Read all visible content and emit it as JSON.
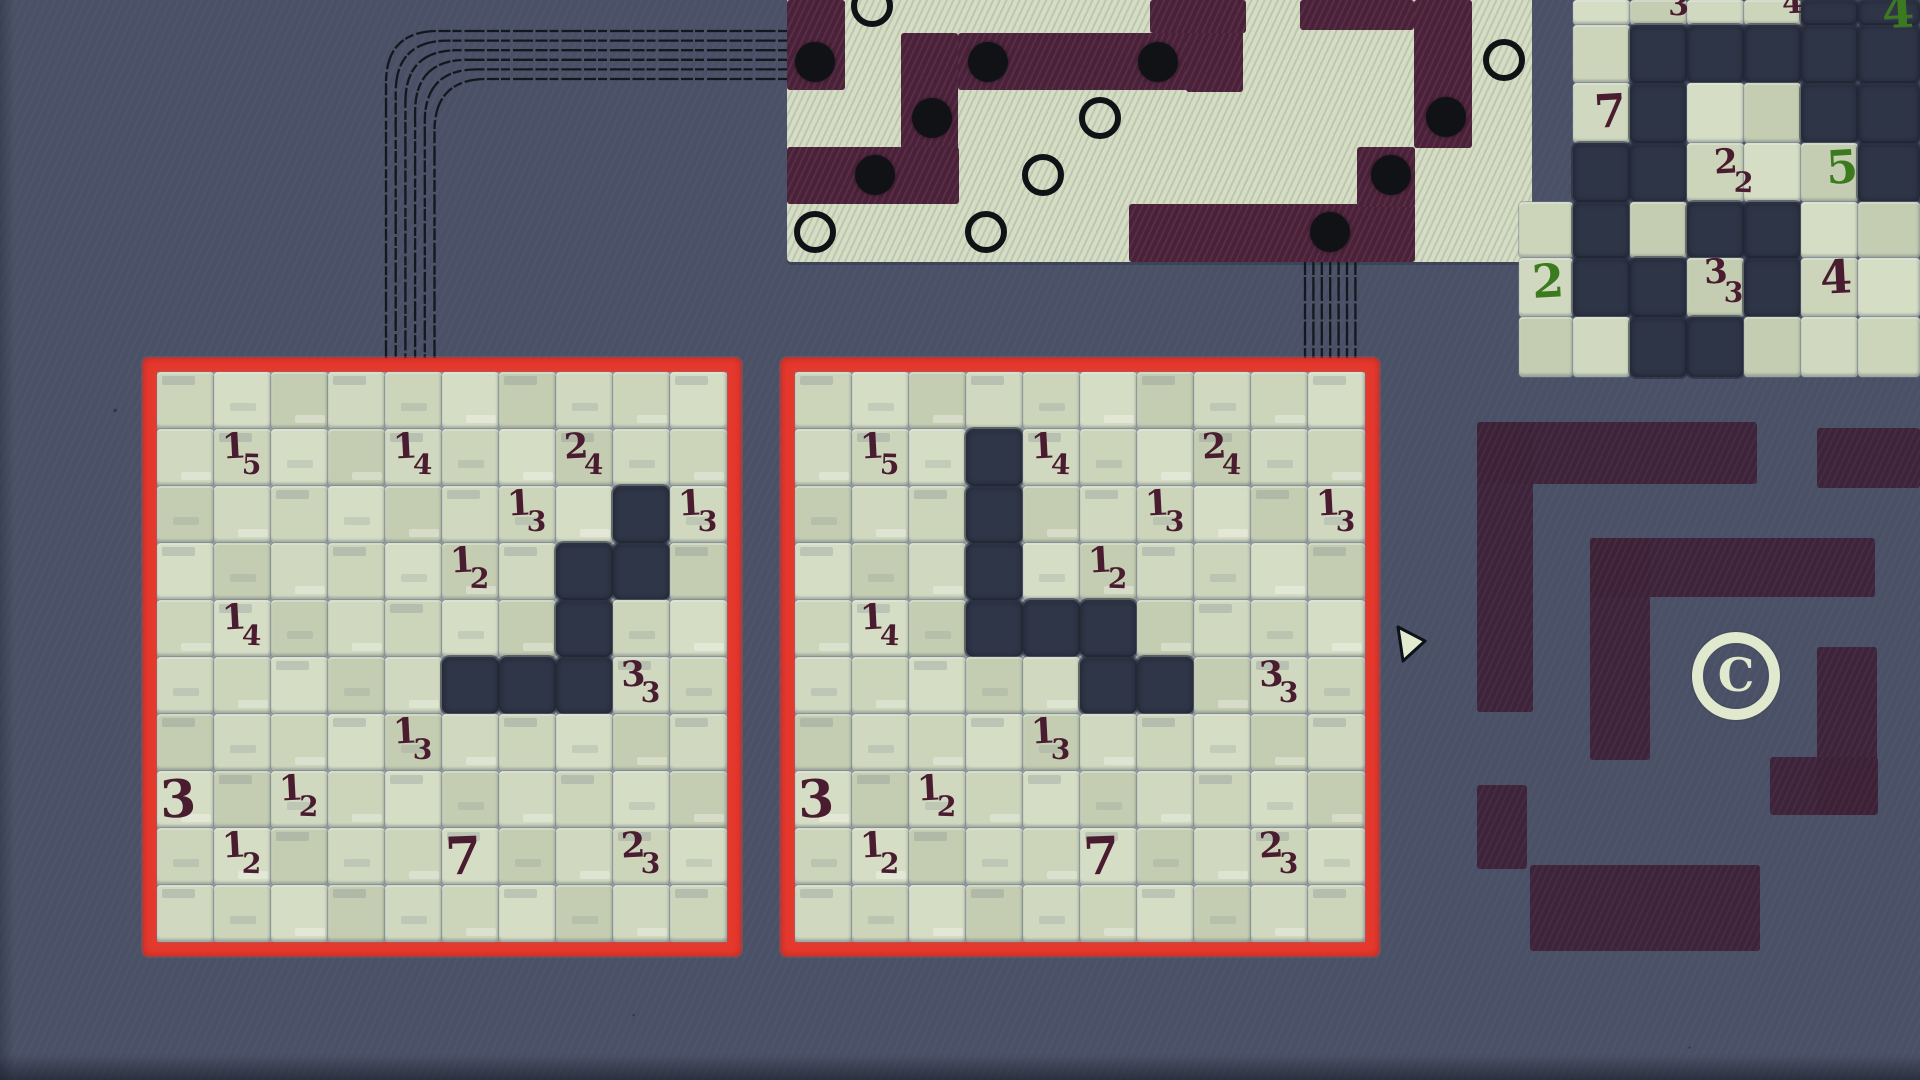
{
  "palette": {
    "background": "#4a5166",
    "frame_red": "#e6392e",
    "cell_dark": "#2f3648",
    "cell_cream_shades": [
      "#ccd4ba",
      "#d6ddc5",
      "#c4cdb1",
      "#d0d8bf"
    ],
    "clue_maroon": "#4a1c30",
    "clue_green": "#3c7a1f",
    "fabric_cream": "#d5ddc3",
    "fabric_maroon": "#4b2139",
    "maze_plum": "#3d2137",
    "pearl_black": "#101216",
    "wire_black": "#13171e",
    "cursor_cream": "#e3ecd1"
  },
  "clue_grids": {
    "rows": 10,
    "cols": 10,
    "cell_px": 57,
    "shared_clues": [
      {
        "row": 1,
        "col": 1,
        "big": "1",
        "small": "5"
      },
      {
        "row": 1,
        "col": 4,
        "big": "1",
        "small": "4"
      },
      {
        "row": 1,
        "col": 7,
        "big": "2",
        "small": "4"
      },
      {
        "row": 2,
        "col": 6,
        "big": "1",
        "small": "3"
      },
      {
        "row": 2,
        "col": 9,
        "big": "1",
        "small": "3"
      },
      {
        "row": 3,
        "col": 5,
        "big": "1",
        "small": "2"
      },
      {
        "row": 4,
        "col": 1,
        "big": "1",
        "small": "4"
      },
      {
        "row": 5,
        "col": 8,
        "big": "3",
        "small": "3"
      },
      {
        "row": 6,
        "col": 4,
        "big": "1",
        "small": "3"
      },
      {
        "row": 7,
        "col": 0,
        "big": "3",
        "small": ""
      },
      {
        "row": 7,
        "col": 2,
        "big": "1",
        "small": "2"
      },
      {
        "row": 8,
        "col": 1,
        "big": "1",
        "small": "2"
      },
      {
        "row": 8,
        "col": 5,
        "big": "7",
        "small": ""
      },
      {
        "row": 8,
        "col": 8,
        "big": "2",
        "small": "3"
      }
    ],
    "left": {
      "x": 143,
      "y": 358,
      "filled_cells": [
        [
          2,
          8
        ],
        [
          3,
          7
        ],
        [
          3,
          8
        ],
        [
          4,
          7
        ],
        [
          5,
          5
        ],
        [
          5,
          6
        ],
        [
          5,
          7
        ]
      ]
    },
    "right": {
      "x": 781,
      "y": 358,
      "filled_cells": [
        [
          1,
          3
        ],
        [
          2,
          3
        ],
        [
          3,
          3
        ],
        [
          4,
          3
        ],
        [
          4,
          4
        ],
        [
          4,
          5
        ],
        [
          5,
          5
        ],
        [
          5,
          6
        ]
      ]
    }
  },
  "path_puzzle": {
    "origin_x": 787,
    "path_rects": [
      [
        787,
        0,
        58,
        90
      ],
      [
        901,
        33,
        57,
        171
      ],
      [
        958,
        33,
        285,
        57
      ],
      [
        1186,
        0,
        57,
        92
      ],
      [
        1150,
        0,
        96,
        33
      ],
      [
        787,
        147,
        172,
        57
      ],
      [
        1129,
        204,
        286,
        58
      ],
      [
        1357,
        147,
        58,
        60
      ],
      [
        1414,
        0,
        58,
        148
      ],
      [
        1300,
        0,
        114,
        30
      ]
    ],
    "pearls_filled": [
      [
        815,
        62
      ],
      [
        988,
        62
      ],
      [
        932,
        118
      ],
      [
        875,
        175
      ],
      [
        1158,
        62
      ],
      [
        1446,
        117
      ],
      [
        1391,
        175
      ],
      [
        1330,
        232
      ]
    ],
    "pearls_open": [
      [
        872,
        6
      ],
      [
        815,
        232
      ],
      [
        986,
        232
      ],
      [
        1043,
        175
      ],
      [
        1100,
        118
      ],
      [
        1504,
        60
      ]
    ]
  },
  "mosaic_puzzle": {
    "col_x": [
      1519,
      1573,
      1630,
      1687,
      1744,
      1801,
      1858
    ],
    "col_w": [
      54,
      57,
      57,
      57,
      57,
      57,
      62
    ],
    "row_y": [
      0,
      25,
      83,
      143,
      202,
      258,
      317
    ],
    "row_h": [
      25,
      58,
      60,
      59,
      56,
      59,
      60
    ],
    "cells": [
      [
        null,
        "c",
        "c",
        "c",
        "c",
        "d",
        "d"
      ],
      [
        null,
        "c",
        "d",
        "d",
        "d",
        "d",
        "d"
      ],
      [
        null,
        "c",
        "d",
        "c",
        "c",
        "d",
        "d"
      ],
      [
        null,
        "d",
        "d",
        "c",
        "c",
        "c",
        "d"
      ],
      [
        "c",
        "d",
        "c",
        "d",
        "d",
        "c",
        "c"
      ],
      [
        "c",
        "d",
        "d",
        "c",
        "d",
        "c",
        "c"
      ],
      [
        "c",
        "c",
        "d",
        "d",
        "c",
        "c",
        "c"
      ]
    ],
    "clues": [
      {
        "x": 1668,
        "y": -12,
        "kind": "smallonly",
        "color": "maroon",
        "text": "3"
      },
      {
        "x": 1782,
        "y": -14,
        "kind": "smallonly",
        "color": "maroon",
        "text": "4"
      },
      {
        "x": 1882,
        "y": -16,
        "kind": "big",
        "color": "green",
        "text": "4"
      },
      {
        "x": 1594,
        "y": 84,
        "kind": "big",
        "color": "maroon",
        "text": "7"
      },
      {
        "x": 1714,
        "y": 146,
        "kind": "pair",
        "color": "maroon",
        "big": "2",
        "small": "2"
      },
      {
        "x": 1826,
        "y": 140,
        "kind": "big",
        "color": "green",
        "text": "5"
      },
      {
        "x": 1532,
        "y": 254,
        "kind": "big",
        "color": "green",
        "text": "2"
      },
      {
        "x": 1704,
        "y": 256,
        "kind": "pair",
        "color": "maroon",
        "big": "3",
        "small": "3"
      },
      {
        "x": 1820,
        "y": 250,
        "kind": "big",
        "color": "maroon",
        "text": "4"
      }
    ]
  },
  "maze": {
    "symbol": "C",
    "rects": [
      [
        1477,
        422,
        280,
        62
      ],
      [
        1817,
        428,
        103,
        60
      ],
      [
        1477,
        422,
        56,
        290
      ],
      [
        1477,
        785,
        50,
        84
      ],
      [
        1590,
        538,
        285,
        59
      ],
      [
        1590,
        538,
        60,
        222
      ],
      [
        1817,
        647,
        60,
        168
      ],
      [
        1770,
        757,
        108,
        58
      ],
      [
        1530,
        865,
        230,
        86
      ]
    ]
  },
  "wires": {
    "left_bundle": {
      "count": 6,
      "y_start": 31,
      "y_step": 9.6,
      "x_start": 386,
      "x_step": 9.7,
      "h_end": 790,
      "v_end": 362,
      "corner": 52
    },
    "right_bundle": {
      "count": 7,
      "x_start": 1305,
      "x_step": 8.4,
      "y_top": 259,
      "y_bottom": 362
    }
  },
  "cursor": {
    "points": "1398,627 1425,641 1403,661"
  }
}
